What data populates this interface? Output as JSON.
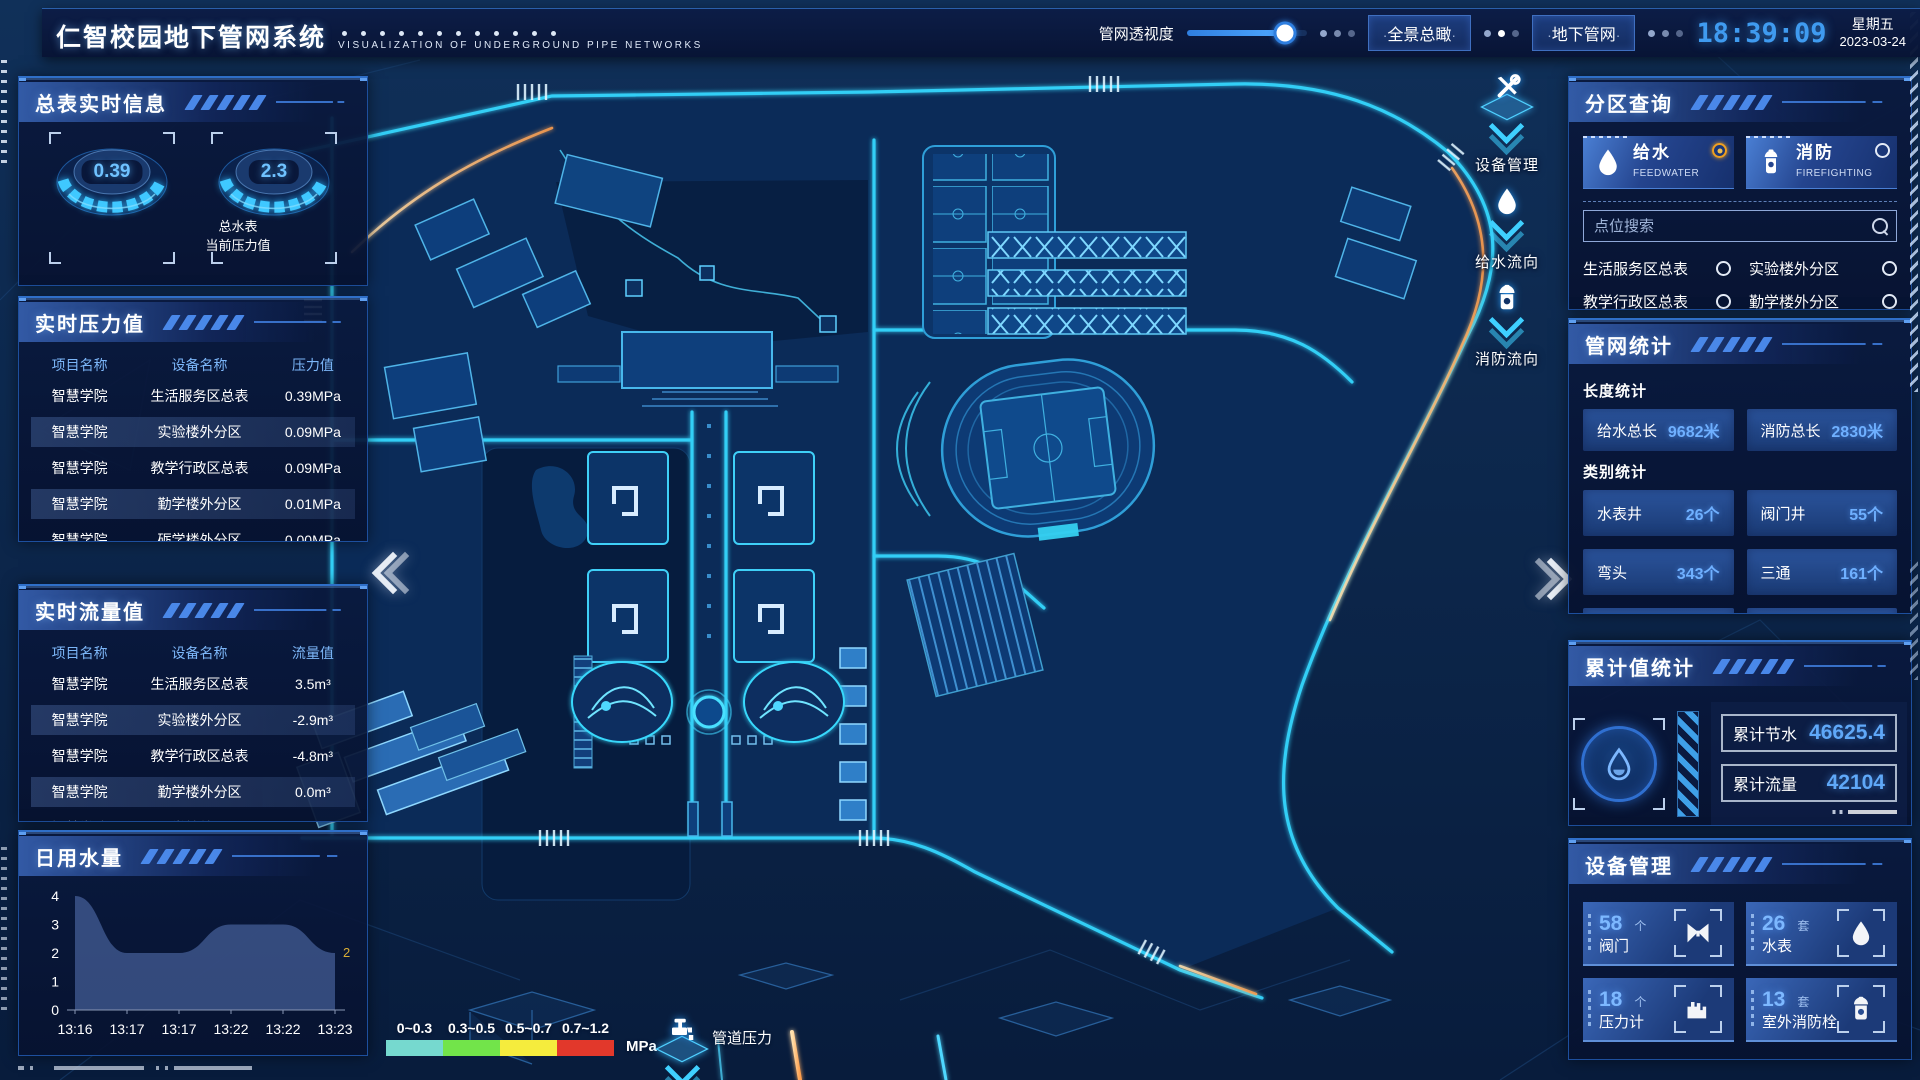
{
  "header": {
    "title": "仁智校园地下管网系统",
    "subtitle": "VISUALIZATION OF UNDERGROUND PIPE NETWORKS",
    "transparency_label": "管网透视度",
    "btn_overview": "全景总瞰",
    "btn_underground": "地下管网",
    "clock": "18:39:09",
    "weekday": "星期五",
    "date": "2023-03-24"
  },
  "left": {
    "meter_panel": {
      "title": "总表实时信息",
      "gauges": [
        {
          "value": "0.39",
          "label_line1": "总水表",
          "label_line2": "当前压力值"
        },
        {
          "value": "2.3",
          "label_line1": "总水表",
          "label_line2": "瞬时流量"
        }
      ]
    },
    "pressure_panel": {
      "title": "实时压力值",
      "columns": [
        "项目名称",
        "设备名称",
        "压力值"
      ],
      "rows": [
        [
          "智慧学院",
          "生活服务区总表",
          "0.39MPa"
        ],
        [
          "智慧学院",
          "实验楼外分区",
          "0.09MPa"
        ],
        [
          "智慧学院",
          "教学行政区总表",
          "0.09MPa"
        ],
        [
          "智慧学院",
          "勤学楼外分区",
          "0.01MPa"
        ],
        [
          "智慧学院",
          "砺学楼外分区",
          "0.00MPa"
        ]
      ]
    },
    "flow_panel": {
      "title": "实时流量值",
      "columns": [
        "项目名称",
        "设备名称",
        "流量值"
      ],
      "rows": [
        [
          "智慧学院",
          "生活服务区总表",
          "3.5m³"
        ],
        [
          "智慧学院",
          "实验楼外分区",
          "-2.9m³"
        ],
        [
          "智慧学院",
          "教学行政区总表",
          "-4.8m³"
        ],
        [
          "智慧学院",
          "勤学楼外分区",
          "0.0m³"
        ],
        [
          "智慧学院",
          "砺学楼外分区",
          "2.2m³"
        ]
      ]
    },
    "daily_panel": {
      "title": "日用水量"
    }
  },
  "chart_data": {
    "type": "area",
    "title": "日用水量",
    "x": [
      "13:16",
      "13:17",
      "13:17",
      "13:22",
      "13:22",
      "13:23"
    ],
    "values": [
      4,
      2,
      2,
      3,
      3,
      2
    ],
    "ylim": [
      0,
      4
    ],
    "yticks": [
      0,
      1,
      2,
      3,
      4
    ],
    "end_label": "2",
    "xlabel": "",
    "ylabel": "",
    "grid": false,
    "legend_position": "none"
  },
  "right": {
    "zone_panel": {
      "title": "分区查询",
      "tabs": [
        {
          "label": "给水",
          "sub": "FEEDWATER",
          "selected": true
        },
        {
          "label": "消防",
          "sub": "FIREFIGHTING",
          "selected": false
        }
      ],
      "search_placeholder": "点位搜索",
      "items": [
        "生活服务区总表",
        "实验楼外分区",
        "教学行政区总表",
        "勤学楼外分区",
        "砺学楼外分区",
        "宿舍区泵房"
      ]
    },
    "stats_panel": {
      "title": "管网统计",
      "length_label": "长度统计",
      "length_stats": [
        {
          "label": "给水总长",
          "value": "9682米"
        },
        {
          "label": "消防总长",
          "value": "2830米"
        }
      ],
      "category_label": "类别统计",
      "category_stats": [
        {
          "label": "水表井",
          "value": "26个"
        },
        {
          "label": "阀门井",
          "value": "55个"
        },
        {
          "label": "弯头",
          "value": "343个"
        },
        {
          "label": "三通",
          "value": "161个"
        }
      ]
    },
    "cumulative_panel": {
      "title": "累计值统计",
      "rows": [
        {
          "label": "累计节水",
          "value": "46625.4"
        },
        {
          "label": "累计流量",
          "value": "42104"
        }
      ]
    },
    "device_panel": {
      "title": "设备管理",
      "cards": [
        {
          "count": "58",
          "unit": "个",
          "label": "阀门",
          "icon": "valve-icon"
        },
        {
          "count": "26",
          "unit": "套",
          "label": "水表",
          "icon": "water-meter-icon"
        },
        {
          "count": "18",
          "unit": "个",
          "label": "压力计",
          "icon": "pressure-gauge-icon"
        },
        {
          "count": "13",
          "unit": "套",
          "label": "室外消防栓",
          "icon": "hydrant-icon"
        }
      ]
    }
  },
  "map": {
    "float_buttons": [
      {
        "label": "设备管理",
        "icon": "tools-icon"
      },
      {
        "label": "给水流向",
        "icon": "water-drop-icon"
      },
      {
        "label": "消防流向",
        "icon": "hydrant-icon"
      }
    ],
    "legend": {
      "ranges": [
        {
          "label": "0~0.3",
          "color": "#76d9cf"
        },
        {
          "label": "0.3~0.5",
          "color": "#72e44a"
        },
        {
          "label": "0.5~0.7",
          "color": "#f5ec3d"
        },
        {
          "label": "0.7~1.2",
          "color": "#e2382b"
        }
      ],
      "unit": "MPa",
      "pipe_pressure_label": "管道压力"
    },
    "colors": {
      "road_glow": "#35d8ff",
      "accent_amber": "#ffb066"
    }
  }
}
